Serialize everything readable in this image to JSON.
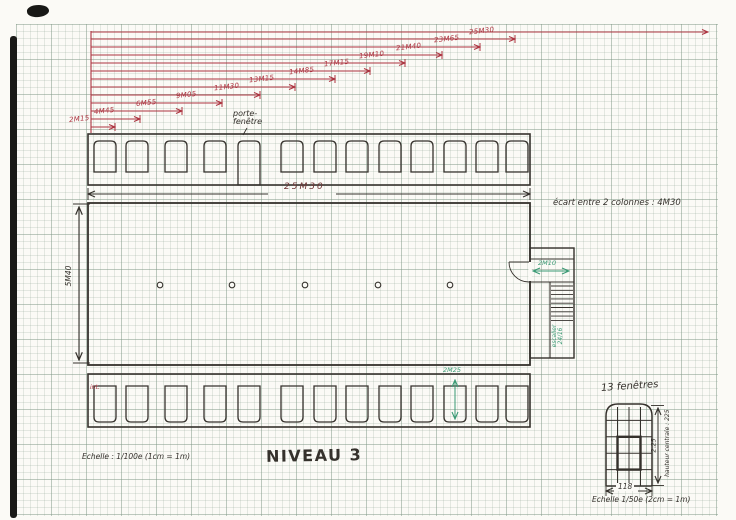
{
  "palette": {
    "ink": "#35312c",
    "red": "#ac3440",
    "green": "#3a9a74",
    "maroon": "#6e3434",
    "paper": "#fbfaf6"
  },
  "titles": {
    "level": "NIVEAU 3",
    "scale_main": "Echelle : 1/100e (1cm = 1m)"
  },
  "top_annotations": {
    "porte_fenetre_line1": "porte-",
    "porte_fenetre_line2": "fenêtre",
    "total_width": "25M30",
    "column_spacing_note": "écart entre 2 colonnes : 4M30"
  },
  "fan_measurements": {
    "description": "cumulative red measurement steps, left to right",
    "top_line": {
      "y": 32,
      "x_end": 708
    },
    "lines": [
      {
        "label": "25M30",
        "y": 39,
        "x_end": 515
      },
      {
        "label": "23M65",
        "y": 47,
        "x_end": 480
      },
      {
        "label": "21M40",
        "y": 55,
        "x_end": 442
      },
      {
        "label": "19M10",
        "y": 63,
        "x_end": 405
      },
      {
        "label": "17M15",
        "y": 71,
        "x_end": 370
      },
      {
        "label": "14M85",
        "y": 79,
        "x_end": 335
      },
      {
        "label": "13M15",
        "y": 87,
        "x_end": 295
      },
      {
        "label": "11M30",
        "y": 95,
        "x_end": 260
      },
      {
        "label": "9M05",
        "y": 103,
        "x_end": 222
      },
      {
        "label": "6M55",
        "y": 111,
        "x_end": 182
      },
      {
        "label": "4M45",
        "y": 119,
        "x_end": 140
      },
      {
        "label": "2M15",
        "y": 127,
        "x_end": 115
      }
    ]
  },
  "plan": {
    "height_dim": "5M40",
    "interior_label": "int.",
    "window_height_dim": "2M25",
    "columns_count": 5,
    "stair": {
      "width_dim": "2M10",
      "label_line1": "escalier",
      "label_line2": "24/16"
    }
  },
  "windows": {
    "count_per_row": 13,
    "porte_fenetre_index": 5
  },
  "detail": {
    "title": "13 fenêtres",
    "height_dim": "2.25",
    "height_note": "hauteur centrale : 225",
    "width_dim": "118",
    "scale": "Echelle 1/50e (2cm = 1m)",
    "grid_cols": 4,
    "grid_rows": 5
  }
}
